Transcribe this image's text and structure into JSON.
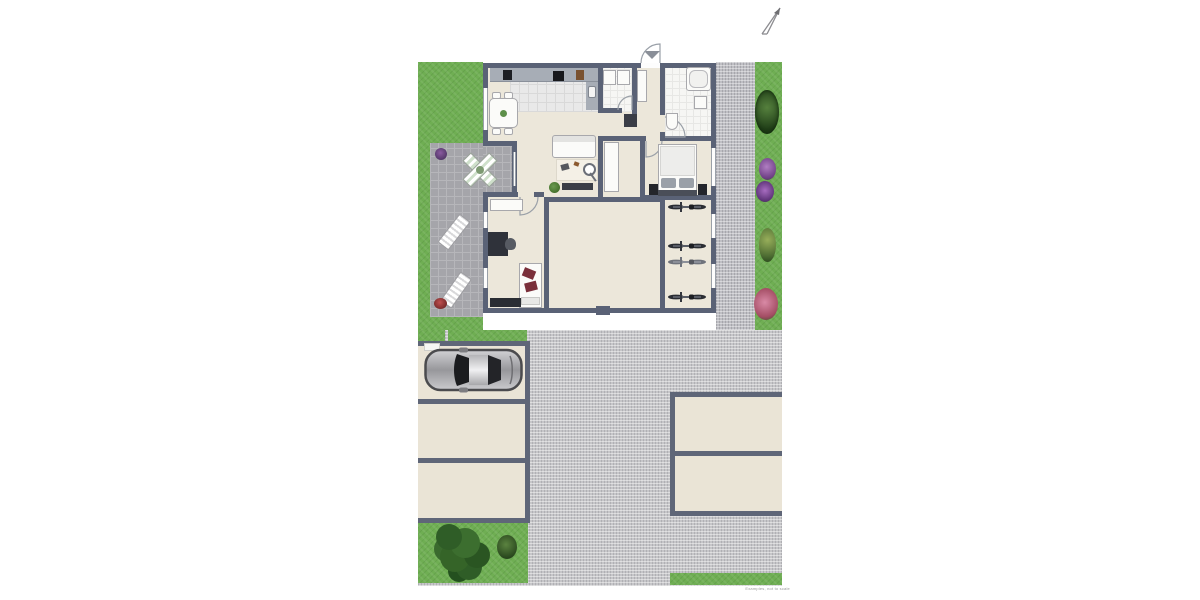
{
  "meta": {
    "plan_type": "residential ground / site plan, top-down 2D render",
    "disclaimer": "Examples, not to scale",
    "north_arrow_direction": "north-east"
  },
  "colors": {
    "wall": "#5a6276",
    "interior_floor": "#ece7da",
    "lawn": "#6fae53",
    "paving": "#c6c6c9",
    "terrace_paving": "#a5a5aa",
    "parking_stall": "#eae4d6",
    "tile": "#f6f6f4",
    "car_body": "#9d9da1",
    "accent_flowers": [
      "#6e3f85",
      "#a44d64",
      "#2c4f22"
    ]
  },
  "rooms": [
    {
      "name": "kitchen-dining"
    },
    {
      "name": "living-room"
    },
    {
      "name": "utility-room"
    },
    {
      "name": "entry-hall"
    },
    {
      "name": "bathroom"
    },
    {
      "name": "hallway"
    },
    {
      "name": "bedroom"
    },
    {
      "name": "office-guest-room"
    },
    {
      "name": "storage-room"
    },
    {
      "name": "bike-room"
    },
    {
      "name": "terrace"
    }
  ],
  "furniture": {
    "kitchen": [
      "counter-with-appliances",
      "sink",
      "dining-table-4-chairs"
    ],
    "living": [
      "sofa",
      "rug-coffee-table",
      "floor-lamp",
      "plant",
      "tv-sideboard"
    ],
    "utility": [
      "washer",
      "dryer"
    ],
    "bathroom": [
      "bathtub",
      "sink",
      "toilet"
    ],
    "bedroom": [
      "double-bed",
      "nightstands"
    ],
    "office": [
      "desk",
      "office-chair",
      "single-bed",
      "shelf",
      "sideboard"
    ],
    "terrace": [
      "parasol-table",
      "sun-lounger",
      "sun-lounger",
      "flower-pots"
    ]
  },
  "outdoor": {
    "parking_stalls_left": 3,
    "parking_stalls_right": 2,
    "cars": 1,
    "bicycles": 4,
    "flower_beds_right_strip": 5,
    "trees": 1,
    "shrubs": 1,
    "sun_loungers": 2
  }
}
